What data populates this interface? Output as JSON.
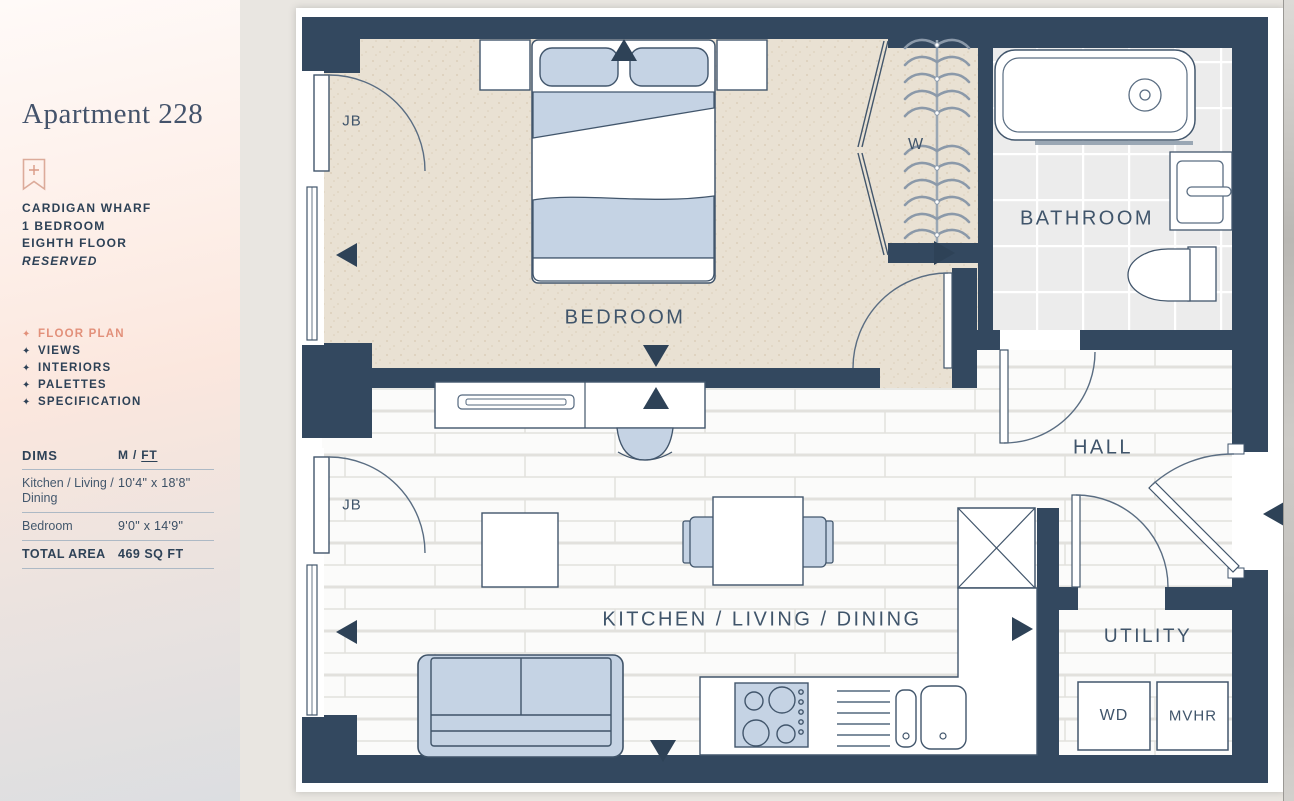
{
  "sidebar": {
    "title": "Apartment 228",
    "details": {
      "development": "CARDIGAN WHARF",
      "bedrooms": "1 BEDROOM",
      "floor": "EIGHTH FLOOR",
      "status": "RESERVED"
    },
    "nav_bullet": "✦",
    "nav": [
      {
        "label": "FLOOR PLAN",
        "active": true
      },
      {
        "label": "VIEWS",
        "active": false
      },
      {
        "label": "INTERIORS",
        "active": false
      },
      {
        "label": "PALETTES",
        "active": false
      },
      {
        "label": "SPECIFICATION",
        "active": false
      }
    ],
    "dims": {
      "heading": "DIMS",
      "unit_metric": "M",
      "unit_separator": "/",
      "unit_imperial": "FT",
      "rows": [
        {
          "label": "Kitchen / Living / Dining",
          "value": "10'4\" x 18'8\""
        },
        {
          "label": "Bedroom",
          "value": "9'0\" x 14'9\""
        }
      ],
      "total_label": "TOTAL AREA",
      "total_value": "469 SQ FT"
    }
  },
  "floorplan": {
    "labels": {
      "bedroom": "BEDROOM",
      "bathroom": "BATHROOM",
      "hall": "HALL",
      "kitchen_living_dining": "KITCHEN / LIVING / DINING",
      "utility": "UTILITY",
      "wardrobe": "W",
      "washer_dryer": "WD",
      "mvhr": "MVHR",
      "juliet_balcony": "JB"
    },
    "colors": {
      "wall": "#33485F",
      "furniture_fill": "#C5D3E4",
      "bedroom_floor": "#E9E1D3",
      "accent": "#E2907A"
    }
  }
}
